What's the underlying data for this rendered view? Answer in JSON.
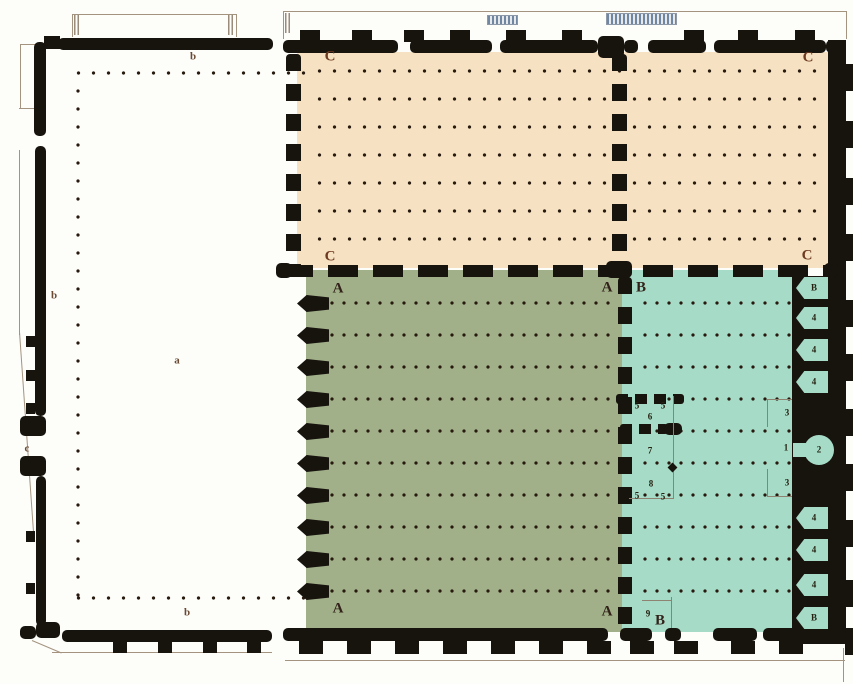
{
  "plan": {
    "wall_color": "#17130d",
    "dot_color": "#27190e",
    "zones": [
      {
        "id": "courtyard",
        "key": "a",
        "color": "#fdfdfa"
      },
      {
        "id": "phase-c",
        "key": "C",
        "color": "#f6e2c2"
      },
      {
        "id": "phase-a",
        "key": "A",
        "color": "#a1b089"
      },
      {
        "id": "phase-b",
        "key": "B",
        "color": "#a6dbc8"
      }
    ],
    "labels": [
      {
        "text": "b",
        "x": 193,
        "y": 57,
        "cls": "small"
      },
      {
        "text": "b",
        "x": 54,
        "y": 296,
        "cls": "small"
      },
      {
        "text": "c",
        "x": 27,
        "y": 449,
        "cls": "small"
      },
      {
        "text": "a",
        "x": 177,
        "y": 361,
        "cls": "small"
      },
      {
        "text": "b",
        "x": 187,
        "y": 613,
        "cls": "small"
      },
      {
        "text": "C",
        "x": 330,
        "y": 57,
        "cls": "c-red"
      },
      {
        "text": "C",
        "x": 808,
        "y": 58,
        "cls": "c-red"
      },
      {
        "text": "C",
        "x": 330,
        "y": 257,
        "cls": "c-red"
      },
      {
        "text": "C",
        "x": 807,
        "y": 256,
        "cls": "c-red"
      },
      {
        "text": "A",
        "x": 338,
        "y": 289,
        "cls": "big"
      },
      {
        "text": "A",
        "x": 607,
        "y": 288,
        "cls": "big"
      },
      {
        "text": "A",
        "x": 338,
        "y": 609,
        "cls": "big"
      },
      {
        "text": "A",
        "x": 607,
        "y": 612,
        "cls": "big"
      },
      {
        "text": "B",
        "x": 641,
        "y": 288,
        "cls": "big"
      },
      {
        "text": "B",
        "x": 660,
        "y": 621,
        "cls": "big"
      },
      {
        "text": "5",
        "x": 637,
        "y": 406,
        "cls": "num"
      },
      {
        "text": "5",
        "x": 663,
        "y": 406,
        "cls": "num"
      },
      {
        "text": "6",
        "x": 650,
        "y": 417,
        "cls": "num"
      },
      {
        "text": "7",
        "x": 650,
        "y": 451,
        "cls": "num"
      },
      {
        "text": "8",
        "x": 651,
        "y": 484,
        "cls": "num"
      },
      {
        "text": "5",
        "x": 637,
        "y": 496,
        "cls": "num"
      },
      {
        "text": "5",
        "x": 663,
        "y": 497,
        "cls": "num"
      },
      {
        "text": "9",
        "x": 648,
        "y": 614,
        "cls": "num"
      },
      {
        "text": "1",
        "x": 786,
        "y": 448,
        "cls": "num"
      },
      {
        "text": "3",
        "x": 787,
        "y": 413,
        "cls": "num"
      },
      {
        "text": "3",
        "x": 787,
        "y": 483,
        "cls": "num"
      }
    ],
    "right_chambers": [
      {
        "y": 288,
        "label": "B"
      },
      {
        "y": 318,
        "label": "4"
      },
      {
        "y": 350,
        "label": "4"
      },
      {
        "y": 382,
        "label": "4"
      },
      {
        "y": 450,
        "label": "2",
        "shape": "mihrab"
      },
      {
        "y": 518,
        "label": "4"
      },
      {
        "y": 550,
        "label": "4"
      },
      {
        "y": 585,
        "label": "4"
      },
      {
        "y": 618,
        "label": "B"
      }
    ]
  }
}
